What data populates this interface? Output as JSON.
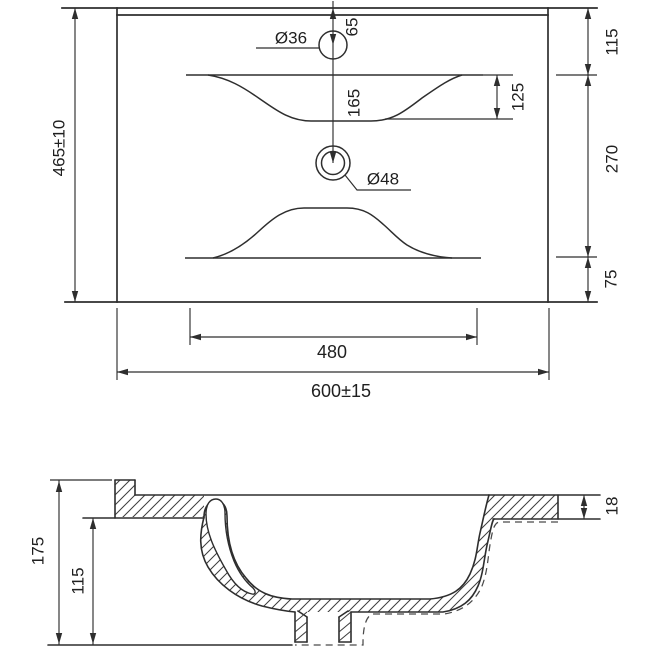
{
  "drawing_type": "washbasin technical dimension drawing",
  "colors": {
    "line": "#2e2e2e",
    "background": "#ffffff"
  },
  "top_view": {
    "overall_depth": "465±10",
    "overall_width": "600±15",
    "basin_cutout_width": "480",
    "faucet_hole_diameter": "Ø36",
    "faucet_hole_from_back": "65",
    "drain_hole_diameter": "Ø48",
    "faucet_to_drain": "165",
    "basin_front_drop": "125",
    "back_edge_to_basin": "115",
    "basin_span": "270",
    "basin_to_front_edge": "75"
  },
  "section_view": {
    "overall_height": "175",
    "bowl_depth": "115",
    "rim_thickness": "18"
  }
}
